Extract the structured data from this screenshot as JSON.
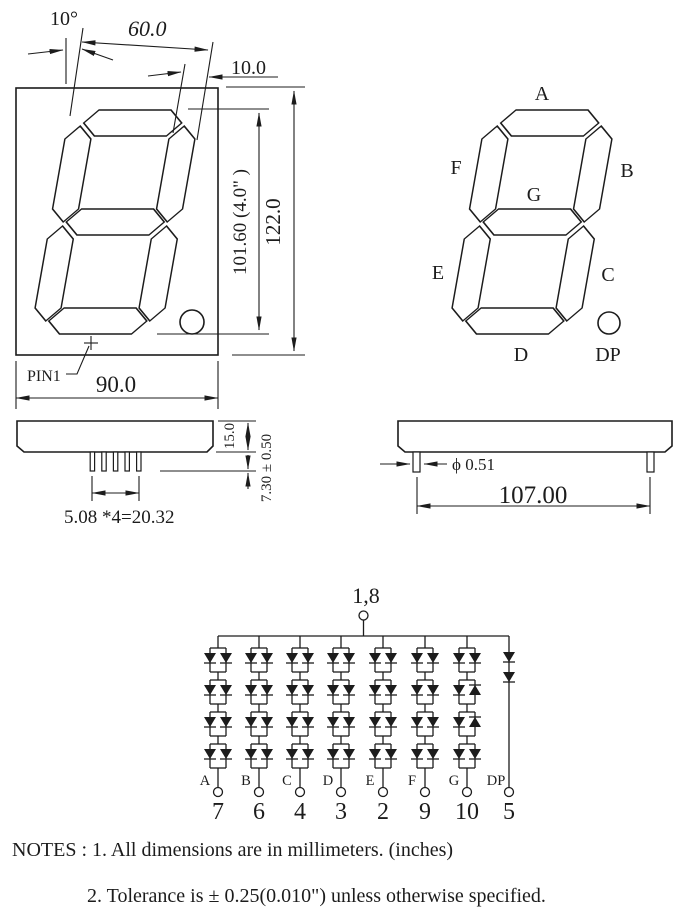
{
  "drawing": {
    "front_view": {
      "angle": "10°",
      "digit_width": "60.0",
      "top_offset": "10.0",
      "digit_height": "101.60 (4.0\" )",
      "package_height": "122.0",
      "package_width": "90.0",
      "pin1": "PIN1"
    },
    "bottom_view": {
      "body_thickness": "15.0",
      "pin_length": "7.30 ± 0.50",
      "pin_pitch": "5.08 *4=20.32"
    },
    "side_view": {
      "pin_diameter": "ϕ 0.51",
      "pin_row_span": "107.00"
    },
    "segment_diagram": {
      "a": "A",
      "b": "B",
      "c": "C",
      "d": "D",
      "e": "E",
      "f": "F",
      "g": "G",
      "dp": "DP"
    }
  },
  "schematic": {
    "common_pins": "1,8",
    "columns": [
      {
        "segment": "A",
        "pin": "7",
        "type": "pairs",
        "cells": [
          "dd",
          "dd",
          "dd",
          "dd"
        ]
      },
      {
        "segment": "B",
        "pin": "6",
        "type": "pairs",
        "cells": [
          "dd",
          "dd",
          "dd",
          "dd"
        ]
      },
      {
        "segment": "C",
        "pin": "4",
        "type": "pairs",
        "cells": [
          "dd",
          "dd",
          "dd",
          "dd"
        ]
      },
      {
        "segment": "D",
        "pin": "3",
        "type": "pairs",
        "cells": [
          "dd",
          "dd",
          "dd",
          "dd"
        ]
      },
      {
        "segment": "E",
        "pin": "2",
        "type": "pairs",
        "cells": [
          "dd",
          "dd",
          "dd",
          "dd"
        ]
      },
      {
        "segment": "F",
        "pin": "9",
        "type": "pairs",
        "cells": [
          "dd",
          "dd",
          "dd",
          "dd"
        ]
      },
      {
        "segment": "G",
        "pin": "10",
        "type": "pairs",
        "cells": [
          "dd",
          "du",
          "du",
          "dd"
        ]
      },
      {
        "segment": "DP",
        "pin": "5",
        "type": "series",
        "diode_count": 2
      }
    ]
  },
  "notes": [
    "NOTES : 1. All dimensions are in millimeters. (inches)",
    "2. Tolerance is  ±  0.25(0.010\") unless otherwise specified."
  ],
  "colors": {
    "ink": "#1c1c1c",
    "paper": "#ffffff"
  }
}
